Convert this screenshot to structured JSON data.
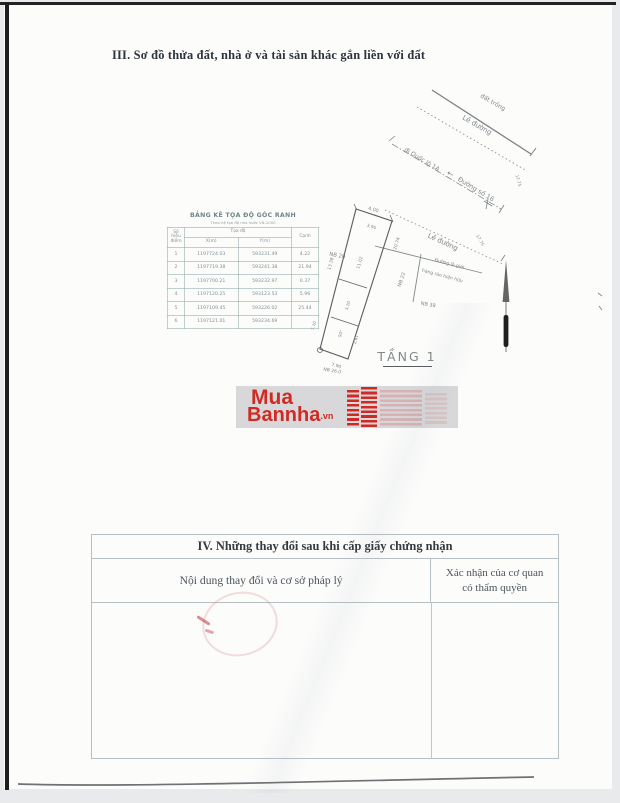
{
  "colors": {
    "logo_red": "#cf2b24",
    "stamp_pink": "#d67a88",
    "paper": "#fcfcfb"
  },
  "section3": {
    "title": "III. Sơ đồ thửa đất, nhà ở và tài sản khác gắn liền với đất"
  },
  "coord_table": {
    "title": "BẢNG KÊ TỌA ĐỘ GÓC RANH",
    "subtitle": "Theo hệ tọa độ nhà nước VN-2000",
    "col_point": "Số hiệu điểm",
    "col_coords": "Tọa độ",
    "col_x": "X(m)",
    "col_y": "Y(m)",
    "col_edge": "Cạnh",
    "rows": [
      {
        "p": "1",
        "x": "1197724.03",
        "y": "593231.49",
        "c": "4.22"
      },
      {
        "p": "2",
        "x": "1197719.38",
        "y": "593241.38",
        "c": "21.94"
      },
      {
        "p": "3",
        "x": "1197700.21",
        "y": "593232.97",
        "c": "0.37"
      },
      {
        "p": "4",
        "x": "1197120.25",
        "y": "593123.53",
        "c": "5.96"
      },
      {
        "p": "5",
        "x": "1197109.45",
        "y": "593226.02",
        "c": "25.44"
      },
      {
        "p": "6",
        "x": "1197121.01",
        "y": "593234.69",
        "c": ""
      }
    ]
  },
  "diagram": {
    "floor_label": "TẦNG 1",
    "vacant_land": "đất trống",
    "road_edge": "Lề đường",
    "to_highway": "đi Quốc lộ 1A",
    "arrow_left": "←",
    "street16": "Đường số 16",
    "corridor_line1": "Đường lộ giới",
    "corridor_line2": "hàng rào hiện hữu",
    "plot_nb20": "NB 20",
    "plot_nb22": "NB 22",
    "plot_nb38": "NB 38",
    "plot_nb26": "NB 26.0",
    "m_top": "4.00",
    "m_top2": "3.95",
    "m_right_upper": "20.74",
    "m_right_inner": "11.02",
    "m_left": "13.38",
    "m_inner": "3.10",
    "m_angle": "50°",
    "m_lower_right": "2.61",
    "m_lower_left": "7.10",
    "m_bottom": "7.90",
    "m_width": "17.75"
  },
  "logo": {
    "line1": "Mua",
    "line2": "Bannha",
    "suffix": ".vn"
  },
  "section4": {
    "title": "IV. Những thay đổi sau khi cấp giấy chứng nhận",
    "col_left": "Nội dung thay đổi và cơ sở pháp lý",
    "col_right_line1": "Xác nhận của cơ quan",
    "col_right_line2": "có thẩm quyền"
  }
}
